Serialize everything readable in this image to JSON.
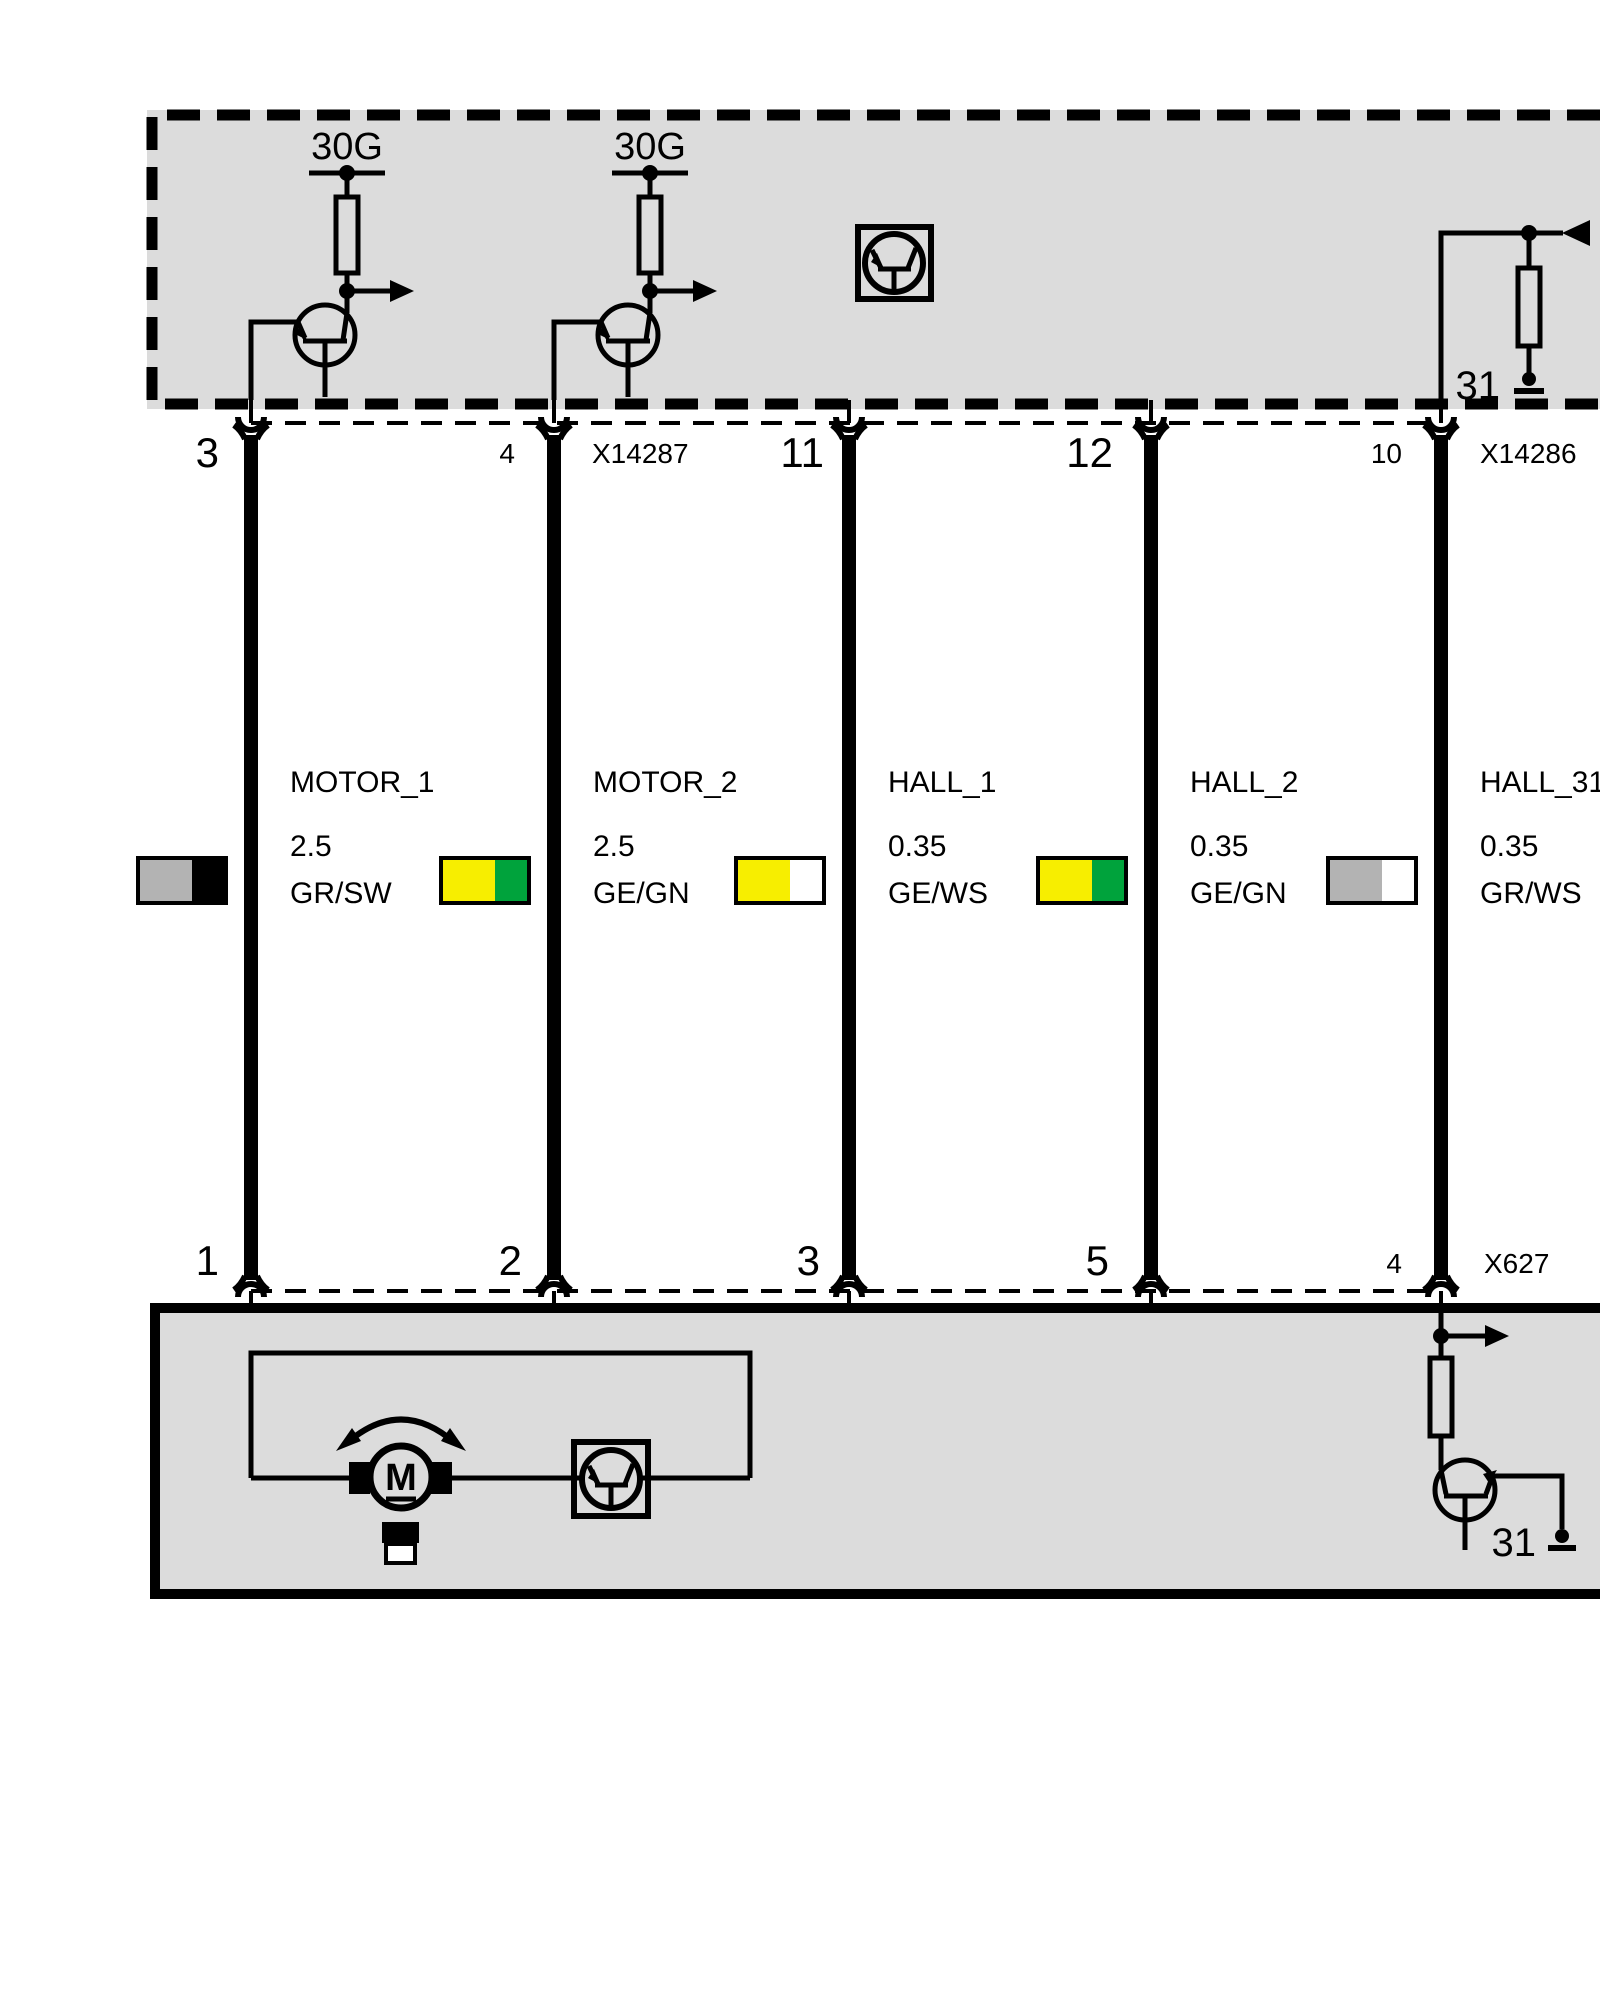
{
  "colors": {
    "module_fill": "#DCDCDC",
    "line": "#000000",
    "wire_gray": "#B3B3B3",
    "wire_black": "#000000",
    "wire_yellow": "#F7EE00",
    "wire_green": "#00A33C",
    "wire_white": "#FFFFFF"
  },
  "top_module": {
    "fuses": [
      "30G",
      "30G"
    ],
    "ground_terminal": "31"
  },
  "top_row": {
    "pins": [
      "3",
      "4",
      "11",
      "12",
      "10"
    ],
    "connectors": [
      "X14287",
      "X14286"
    ]
  },
  "wires": [
    {
      "name": "MOTOR_1",
      "gauge": "2.5",
      "code": "GR/SW",
      "swatch": [
        "#B3B3B3",
        "#000000"
      ]
    },
    {
      "name": "MOTOR_2",
      "gauge": "2.5",
      "code": "GE/GN",
      "swatch": [
        "#F7EE00",
        "#00A33C"
      ]
    },
    {
      "name": "HALL_1",
      "gauge": "0.35",
      "code": "GE/WS",
      "swatch": [
        "#F7EE00",
        "#FFFFFF"
      ]
    },
    {
      "name": "HALL_2",
      "gauge": "0.35",
      "code": "GE/GN",
      "swatch": [
        "#F7EE00",
        "#00A33C"
      ]
    },
    {
      "name": "HALL_31",
      "gauge": "0.35",
      "code": "GR/WS",
      "swatch": [
        "#B3B3B3",
        "#FFFFFF"
      ]
    }
  ],
  "bottom_row": {
    "pins": [
      "1",
      "2",
      "3",
      "5",
      "4"
    ],
    "connectors": [
      "X627"
    ]
  },
  "bottom_module": {
    "motor_label": "M",
    "ground_terminal": "31"
  }
}
